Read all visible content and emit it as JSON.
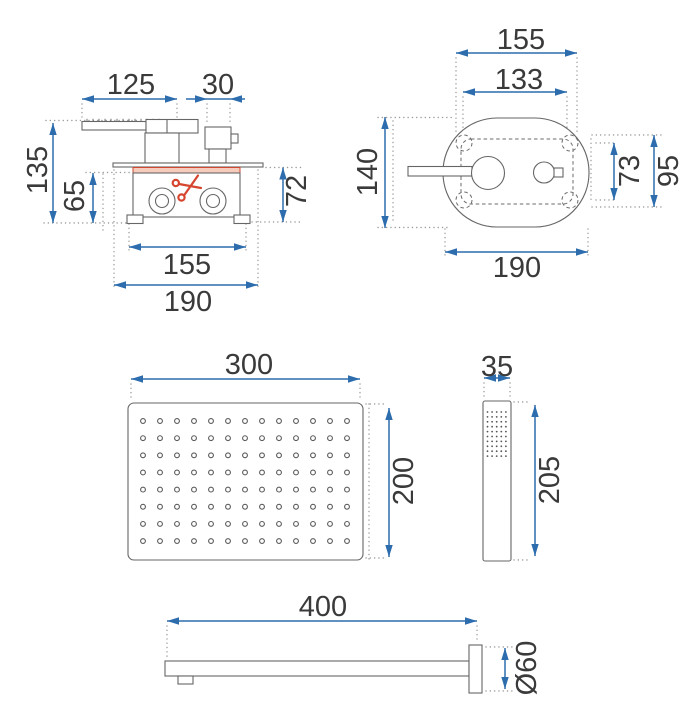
{
  "colors": {
    "background": "#ffffff",
    "dimension_blue": "#2d6dad",
    "drawing_gray": "#666666",
    "dotted_gray": "#9b9b9b",
    "cut_red": "#d6452e",
    "cut_band_fill": "#f6cbbb",
    "text_dark": "#3a3a3a"
  },
  "icons": {
    "scissors_cut_icon": "✂"
  },
  "views": {
    "mixer_front_view": {
      "dims": {
        "handle_span": "125",
        "knob_width": "30",
        "total_height": "135",
        "inner_height": "65",
        "box_height": "72",
        "inner_width": "155",
        "outer_width": "190"
      }
    },
    "mixer_face_view": {
      "dims": {
        "outer_width_top": "155",
        "inner_width": "133",
        "height": "140",
        "inner_height": "73",
        "outer_height": "95",
        "total_width": "190"
      }
    },
    "shower_head_view": {
      "dims": {
        "width": "300",
        "height": "200"
      }
    },
    "hand_shower_view": {
      "dims": {
        "width": "35",
        "height": "205"
      }
    },
    "shower_arm_view": {
      "dims": {
        "length": "400",
        "diameter": "Ø60"
      }
    }
  }
}
